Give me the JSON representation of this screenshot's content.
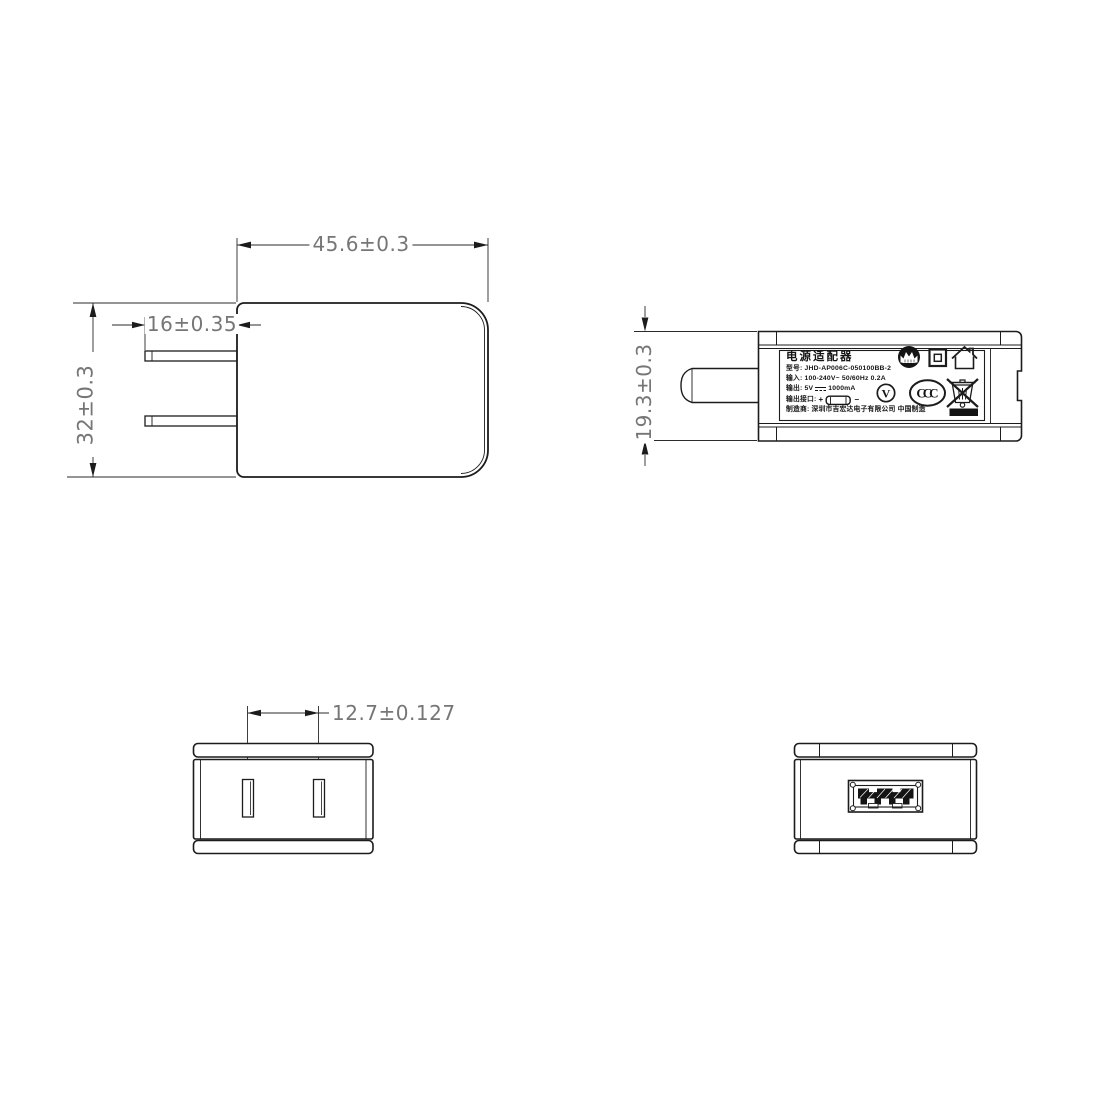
{
  "canvas": {
    "width": 1100,
    "height": 1100,
    "background": "#ffffff"
  },
  "colors": {
    "outline": "#1c1c1c",
    "dim_line": "#2b2b2b",
    "dim_text": "#767676",
    "label_text": "#141414"
  },
  "dimensions": {
    "front_width": "45.6±0.3",
    "front_prong_length": "16±0.35",
    "front_height": "32±0.3",
    "side_thickness": "19.3±0.3",
    "prong_spacing": "12.7±0.127"
  },
  "label": {
    "title": "电源适配器",
    "model": "型号: JHD-AP006C-050100BB-2",
    "input": "输入: 100-240V~  50/60Hz  0.2A",
    "output_prefix": "输出: 5V",
    "output_suffix": "1000mA",
    "port_label": "输出接口:",
    "plus": "+",
    "minus": "−",
    "manufacturer": "制造商: 深圳市吉宏达电子有限公司   中国制造",
    "v_mark": "V",
    "ccc_mark": "CCC"
  },
  "icons": {
    "cqc": "cqc-mark-icon",
    "double_insulation": "double-insulation-icon",
    "indoor_use": "indoor-use-house-icon",
    "efficiency": "efficiency-v-icon",
    "ccc": "ccc-mark-icon",
    "weee": "weee-bin-icon",
    "usb_plug": "usb-plug-icon",
    "dc_symbol": "dc-symbol"
  }
}
